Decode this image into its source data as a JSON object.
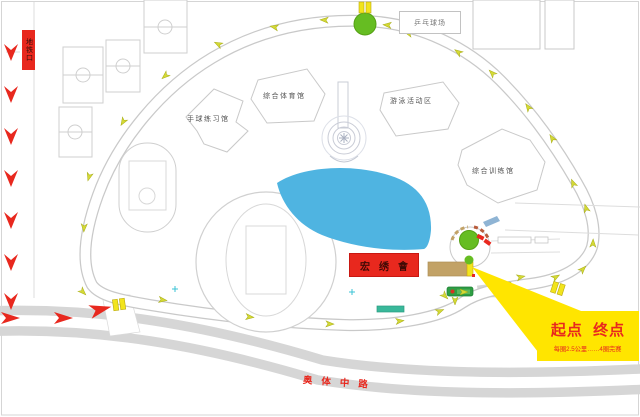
{
  "signs": {
    "left_sign": "地铁口",
    "pingpong": "乒乓球场",
    "road_name": "奥体中路",
    "red_building": "宏绣會"
  },
  "buildings": {
    "handball": "手球练习馆",
    "gym": "综合体育馆",
    "swimming": "游泳活动区",
    "training": "综合训练馆"
  },
  "callout": {
    "title": "起点  终点",
    "subtitle": "每圈2.5公里……4圈完赛"
  },
  "colors": {
    "accent_red": "#e8281e",
    "callout_yellow": "#ffe500",
    "tree_green": "#66bd22",
    "lake_blue": "#4fb4e1",
    "building_tan": "#c2a266",
    "road_gray": "#d6d6d6",
    "route_arrow_yellow": "#d4d935"
  }
}
